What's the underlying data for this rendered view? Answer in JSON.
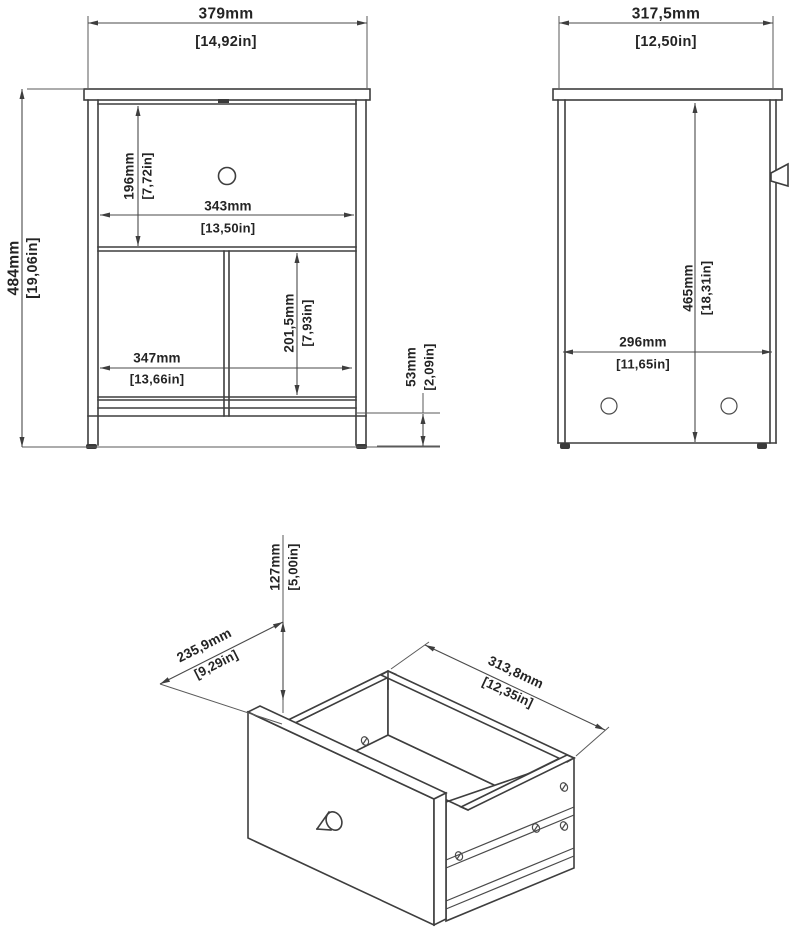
{
  "document": {
    "type": "furniture assembly dimension drawing",
    "subject": "nightstand with drawer and open shelf",
    "background_color": "#ffffff",
    "line_color": "#3e3e3e"
  },
  "views": {
    "front": {
      "label": "front view",
      "dims": {
        "width": {
          "mm": "379mm",
          "in": "[14,92in]"
        },
        "height": {
          "mm": "484mm",
          "in": "[19,06in]"
        },
        "drawer_height": {
          "mm": "196mm",
          "in": "[7,72in]"
        },
        "drawer_width": {
          "mm": "343mm",
          "in": "[13,50in]"
        },
        "shelf_width": {
          "mm": "347mm",
          "in": "[13,66in]"
        },
        "shelf_height": {
          "mm": "201,5mm",
          "in": "[7,93in]"
        },
        "base_height": {
          "mm": "53mm",
          "in": "[2,09in]"
        }
      }
    },
    "side": {
      "label": "side view",
      "dims": {
        "depth": {
          "mm": "317,5mm",
          "in": "[12,50in]"
        },
        "height": {
          "mm": "465mm",
          "in": "[18,31in]"
        },
        "inner_depth": {
          "mm": "296mm",
          "in": "[11,65in]"
        }
      }
    },
    "drawer": {
      "label": "drawer isometric view",
      "dims": {
        "height": {
          "mm": "127mm",
          "in": "[5,00in]"
        },
        "depth": {
          "mm": "235,9mm",
          "in": "[9,29in]"
        },
        "width": {
          "mm": "313,8mm",
          "in": "[12,35in]"
        }
      }
    }
  }
}
